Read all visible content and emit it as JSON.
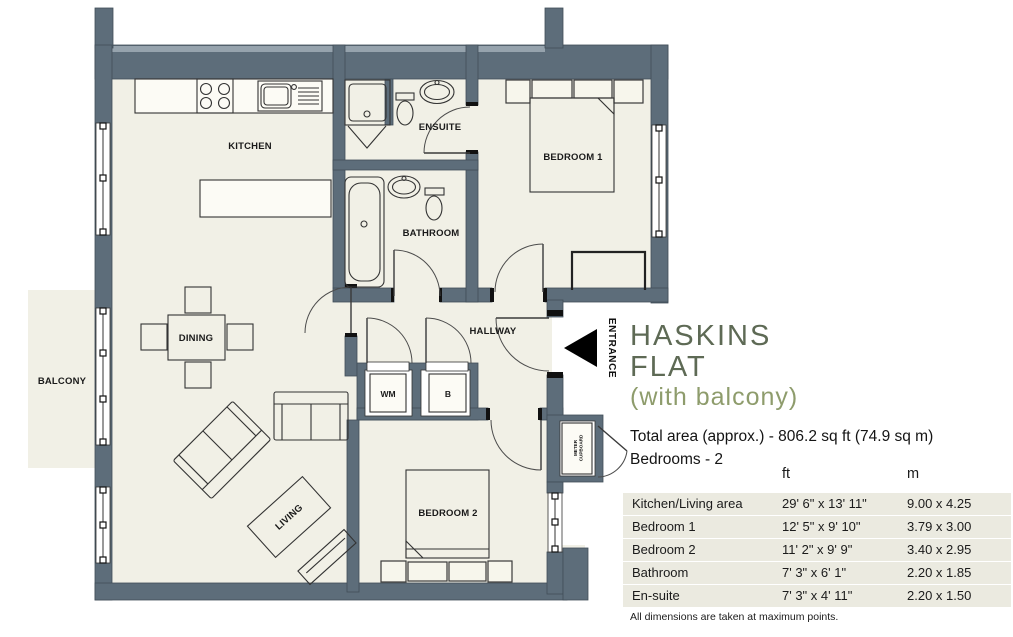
{
  "title": {
    "line1": "HASKINS",
    "line2": "FLAT",
    "subtitle": "(with balcony)"
  },
  "summary": {
    "total_area": "Total area (approx.) - 806.2 sq ft (74.9 sq m)",
    "bedrooms": "Bedrooms - 2"
  },
  "dimensions_table": {
    "headers": {
      "ft": "ft",
      "m": "m"
    },
    "rows": [
      {
        "room": "Kitchen/Living area",
        "ft": "29' 6\" x 13' 11\"",
        "m": "9.00 x 4.25"
      },
      {
        "room": "Bedroom 1",
        "ft": "12' 5\" x 9' 10\"",
        "m": "3.79 x 3.00"
      },
      {
        "room": "Bedroom 2",
        "ft": "11' 2\" x 9' 9\"",
        "m": "3.40 x 2.95"
      },
      {
        "room": "Bathroom",
        "ft": "7' 3\" x 6' 1\"",
        "m": "2.20 x 1.85"
      },
      {
        "room": "En-suite",
        "ft": "7' 3\" x 4' 11\"",
        "m": "2.20 x 1.50"
      }
    ],
    "footnote": "All dimensions are taken at maximum points."
  },
  "floorplan": {
    "rooms": {
      "kitchen": "KITCHEN",
      "ensuite": "ENSUITE",
      "bathroom": "BATHROOM",
      "bedroom1": "BEDROOM 1",
      "dining": "DINING",
      "hallway": "HALLWAY",
      "wm": "WM",
      "b": "B",
      "balcony": "BALCONY",
      "living": "LIVING",
      "bedroom2": "BEDROOM 2"
    },
    "entrance": "ENTRANCE",
    "meter_line1": "METER",
    "meter_line2": "CUPBOARD"
  },
  "colors": {
    "wall": "#5d6d7a",
    "floor": "#f1f0e6",
    "table_band": "#ebeae0",
    "title": "#5e6a55",
    "subtitle": "#8e9c6c",
    "entrance_arrow": "#000000"
  }
}
